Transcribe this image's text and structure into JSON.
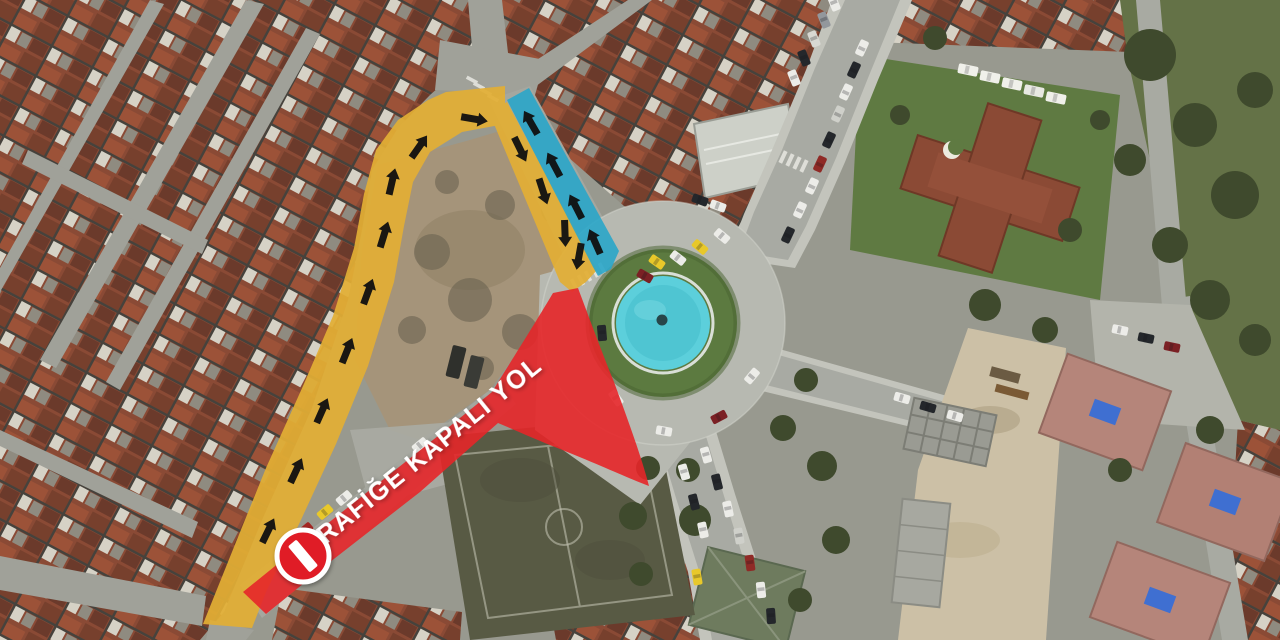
{
  "map": {
    "overlay": {
      "closed_road_label": "TRAFİĞE KAPALI YOL",
      "colors": {
        "closed_road": "#e62629",
        "detour_route": "#e2ae35",
        "return_route": "#2aa6c9",
        "arrow": "#101010",
        "label_text": "#ffffff",
        "sign_red": "#e01f25",
        "sign_bar": "#ffffff"
      },
      "icons": [
        "no-entry-icon",
        "direction-arrow"
      ]
    },
    "landmarks": {
      "roundabout_pool": "#5ccfdb",
      "roundabout_grass": "#5c7a40",
      "sports_field": "#585a44"
    }
  }
}
